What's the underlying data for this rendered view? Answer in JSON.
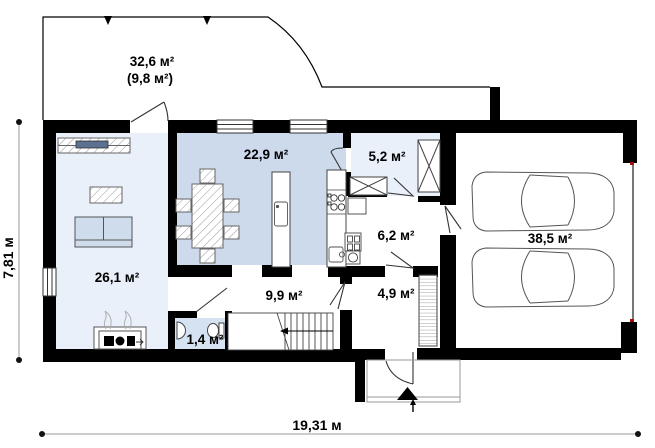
{
  "plan": {
    "rooms": {
      "terrace": {
        "label": "32,6 м²",
        "note": "(9,8 м²)"
      },
      "kitchen_dining": {
        "label": "22,9 м²"
      },
      "pantry": {
        "label": "5,2 м²"
      },
      "bathroom": {
        "label": "6,2 м²"
      },
      "living_room": {
        "label": "26,1 м²"
      },
      "garage": {
        "label": "38,5 м²"
      },
      "hallway": {
        "label": "9,9 м²"
      },
      "entry": {
        "label": "4,9 м²"
      },
      "wc": {
        "label": "1,4 м²"
      }
    },
    "dimensions": {
      "overall_width": "19,31 м",
      "overall_height": "7,81 м"
    },
    "colors": {
      "wall": "#000000",
      "kitchen_floor": "#ccdaec",
      "living_floor": "#e9f0fa",
      "pantry_floor": "#e9f0fa",
      "wc_floor": "#d5e2f2",
      "furniture_line": "#555555",
      "dimension_line": "#9a9a9a"
    }
  }
}
